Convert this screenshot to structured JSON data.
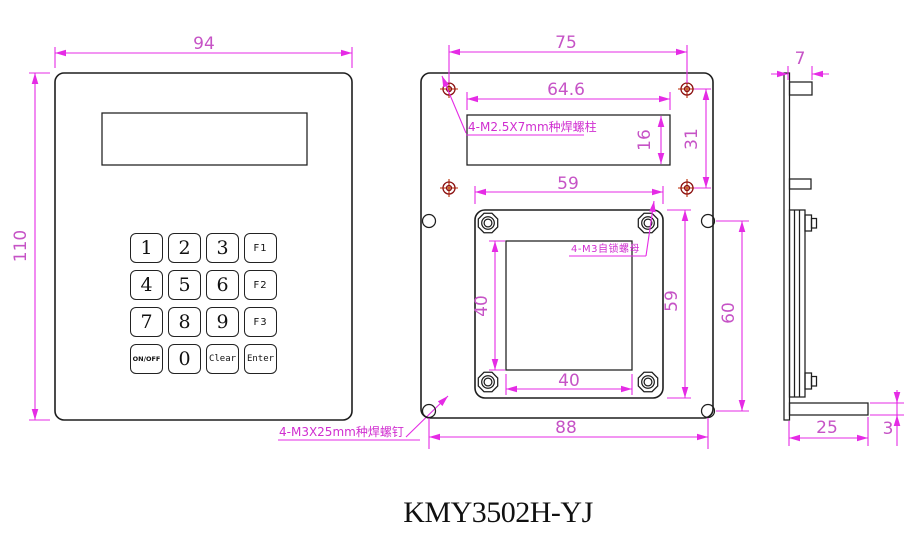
{
  "title": "KMY3502H-YJ",
  "colors": {
    "dimension_lines": "#e52be5",
    "dimension_text": "#c653c6",
    "part_outline": "#1e1e1e",
    "weld_screw_marker": "#8b1010",
    "background": "#ffffff"
  },
  "front_view": {
    "dims": {
      "width": "94",
      "height": "110"
    },
    "note_weld_screw": "4-M3X25mm种焊螺钉",
    "keypad": {
      "keys": [
        "1",
        "2",
        "3",
        "F1",
        "4",
        "5",
        "6",
        "F2",
        "7",
        "8",
        "9",
        "F3",
        "ON/OFF",
        "0",
        "Clear",
        "Enter"
      ]
    }
  },
  "rear_view": {
    "dims": {
      "standoff_span_x": "75",
      "lcd_cutout_width": "64.6",
      "lcd_cutout_height": "16",
      "standoff_span_y": "31",
      "bracket_width": "59",
      "bracket_height": "59",
      "keypad_cutout_width": "40",
      "keypad_cutout_height": "40",
      "stud_span_y": "60",
      "stud_span_x": "88"
    },
    "note_weld_standoff": "4-M2.5X7mm种焊螺柱",
    "note_lock_nut": "4-M3自锁螺母"
  },
  "side_view": {
    "dims": {
      "standoff_depth": "7",
      "bracket_depth": "25",
      "bracket_thickness": "3"
    }
  }
}
